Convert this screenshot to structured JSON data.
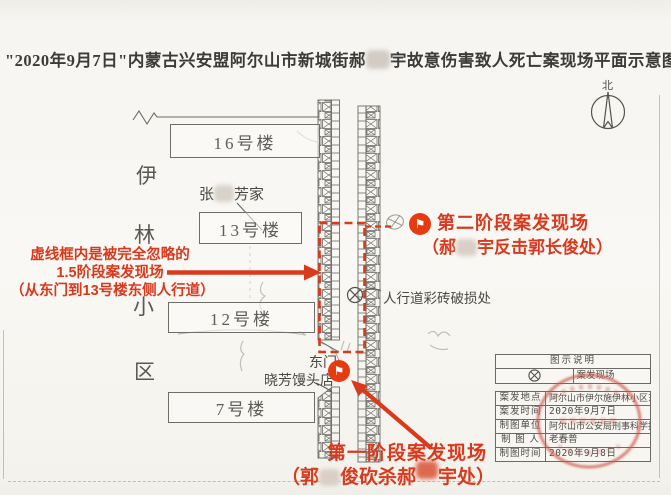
{
  "title": {
    "part1": "\"2020年9月7日\"内蒙古兴安盟阿尔山市新城街郝",
    "part2": "宇故意伤害致人死亡案现场平面示意图一"
  },
  "compass_label": "北",
  "district_label": {
    "char1": "伊",
    "char2": "林",
    "char3": "小",
    "char4": "区"
  },
  "buildings": {
    "b16": "16号楼",
    "b13": "13号楼",
    "b12": "12号楼",
    "b7": "7号楼"
  },
  "map_labels": {
    "resident_part1": "张",
    "resident_part2": "芳家",
    "sidewalk_damage": "人行道彩砖破损处",
    "east_gate": "东门",
    "shop": "晓芳馒头店"
  },
  "annotations": {
    "stage2_line1": "第二阶段案发现场",
    "stage2_line2_a": "（郝",
    "stage2_line2_b": "宇反击郭长俊处）",
    "stage15_line1": "虚线框内是被完全忽略的",
    "stage15_line2": "1.5阶段案发现场",
    "stage15_line3": "（从东门到13号楼东侧人行道）",
    "stage1_line1": "第一阶段案发现场",
    "stage1_line2_a": "（郭",
    "stage1_line2_b": "俊砍杀郝",
    "stage1_line2_c": "宇处）"
  },
  "icons": {
    "flag": "⚑"
  },
  "legend": {
    "title": "图示说明",
    "entry": "案发现场"
  },
  "info_table": {
    "rows": [
      {
        "label": "案发地点",
        "value": "阿尔山市伊尔施伊林小区东门"
      },
      {
        "label": "案发时间",
        "value": "2020年9月7日"
      },
      {
        "label": "制图单位",
        "value": "阿尔山市公安局刑事科学技术室"
      },
      {
        "label": "制 图 人",
        "value": "老春普"
      },
      {
        "label": "制图时间",
        "value": "2020年9月8日"
      }
    ]
  },
  "colors": {
    "annotation_red": "#d9391d",
    "line_gray": "#62605b",
    "stamp_red": "#c8544a"
  }
}
